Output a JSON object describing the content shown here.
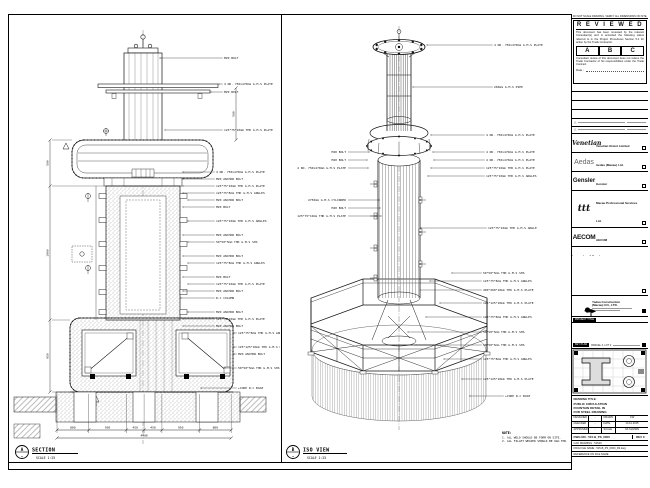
{
  "sheet_notes": {
    "top_strip": "DO NOT SCALE DRAWING. VERIFY ALL DIMENSIONS ON SITE."
  },
  "reviewed": {
    "title": "R E V I E W E D",
    "para1": "This document has been reviewed by the relevant Consultant(s) and is accorded the following status referred to in the Project Procedures Section 5.4 for action by the Trade Contractor.",
    "grades": [
      "A",
      "B",
      "C"
    ],
    "para2": "Consultant review of this document does not relieve the Trade Contractor of his responsibilities under the Trade Contract.",
    "date_label": "Date :"
  },
  "consultants": [
    {
      "logo": "Venetian",
      "name": "Venetian Orient Limited"
    },
    {
      "logo": "Aedas",
      "name": "Aedas (Macau) Ltd."
    },
    {
      "logo": "Gensler",
      "name": "Gensler"
    },
    {
      "logo": "ttt",
      "name": "Macau Professional Services Ltd."
    },
    {
      "logo": "AECOM",
      "name": "AECOM"
    },
    {
      "logo": "Langdon&Seah",
      "name": "Langdon Seah"
    }
  ],
  "contractor": {
    "name_line1": "Yadea Construction",
    "name_line2": "(Macau) CO., LTD."
  },
  "project": {
    "chip_label": "PROJECT TITLE",
    "name": "Cotai Parcel 3"
  },
  "key_plan": {
    "label": "KEY PLAN",
    "note": "PARCEL 3, LOT 2"
  },
  "title_block": {
    "drawing_title_label": "DRAWING TITLE:",
    "title_lines": [
      "PUBLIC CIRCULATION",
      "FOUNTAIN DETAIL IN",
      "FOR STEEL DRAWING"
    ],
    "rows": [
      {
        "label1": "DESIGNED",
        "value1": "-",
        "label2": "DRAWN",
        "value2": "CW"
      },
      {
        "label1": "CHECKED",
        "value1": "-",
        "label2": "DATE",
        "value2": "14.12.2015"
      },
      {
        "label1": "APPROVED",
        "value1": "-",
        "label2": "SCALE",
        "value2": "AS SHOWN"
      }
    ],
    "dwg_no_label": "DWG NO :",
    "dwg_no": "515-B_PS_0000",
    "rev": "REV C",
    "cad_row": "CAD DRAWING : 51549",
    "file_row": "DWG FILE NAME : 515-B_PS_0000_R3.dwg",
    "ref_row": "REFERENCE ON FILE NAME"
  },
  "views": {
    "section": {
      "bubble_top": "A",
      "bubble_bottom": "-",
      "title": "SECTION",
      "scale": "SCALE 1:25"
    },
    "iso": {
      "bubble_top": "B",
      "bubble_bottom": "-",
      "title": "ISO VIEW",
      "scale": "SCALE 1:25"
    }
  },
  "notes": {
    "heading": "NOTE:",
    "items": [
      "1. ALL WELD SHOULD BE FORM ON SITE.",
      "2. ALL FILLET WELDED SHOULD BE 6mm THK."
    ]
  },
  "callouts": {
    "section": [
      "M20 BOLT",
      "4 NO. 750x470mm G.M.S PLATE",
      "M20 BOLT",
      "125*75*10mm THK G.M.S PLATE",
      "4 NO. 750x470mm G.M.S PLATE",
      "M20 ANCHOR BOLT",
      "125*75*10mm THK G.M.S PLATE",
      "125*75*8mm THK G.M.S ANGLES",
      "M20 ANCHOR BOLT",
      "M20 BOLT",
      "125*75*10mm THK G.M.S ANGLES",
      "M20 ANCHOR BOLT",
      "50*50*5mm THK G.M.S SHS",
      "M20 ANCHOR BOLT",
      "125*75*8mm THK G.M.S ANGLES",
      "M20 BOLT",
      "125*75*10mm THK G.M.S PLATE",
      "M20 ANCHOR BOLT",
      "R.C COLUMN",
      "M20 ANCHOR BOLT",
      "125*75*10mm THK G.M.S PLATE",
      "M20 ANCHOR BOLT",
      "125*75*8mm THK G.M.S ANGLES",
      "125*125*10mm THK G.M.S PLATE",
      "M20 ANCHOR BOLT",
      "50*50*5mm THK G.M.S SHS",
      "+CORE R.C BASE"
    ],
    "iso_right": [
      "4 NO. 750x470mm G.M.S PLATE",
      "⌀60mm G.M.S PIPE",
      "4 NO. 750x470mm G.M.S PLATE",
      "4 NO. 750x470mm G.M.S PLATE",
      "4 NO. 750x470mm G.M.S PLATE",
      "125*75*10mm THK G.M.S PLATE",
      "125*75*10mm THK G.M.S ANGLES",
      "125*75*10mm THK G.M.S ANGLE",
      "50*50*5mm THK G.M.S SHS",
      "125*75*8mm THK G.M.S ANGLES",
      "400*200*10mm THK G.M.S PLATE",
      "125*125*10mm THK G.M.S PLATE",
      "125*75*8mm THK G.M.S ANGLES",
      "50*50*5mm THK G.M.S SHS",
      "50*50*5mm THK G.M.S SHS",
      "125*75*8mm THK G.M.S ANGLES",
      "125*125*10mm THK G.M.S PLATE",
      "+CORE R.C BASE"
    ],
    "iso_left": [
      "M20 BOLT",
      "M20 BOLT",
      "4 NO. 750x470mm G.M.S PLATE",
      "⌀750mm G.M.S CYLINDER",
      "M20 BOLT",
      "125*75*10mm THK G.M.S PLATE"
    ]
  },
  "dimensions": {
    "bottom": [
      "800",
      "950",
      "450",
      "450",
      "950",
      "800"
    ],
    "bottom_total": "4400",
    "left": [
      "500",
      "1900",
      "950"
    ],
    "right_top": "500"
  }
}
